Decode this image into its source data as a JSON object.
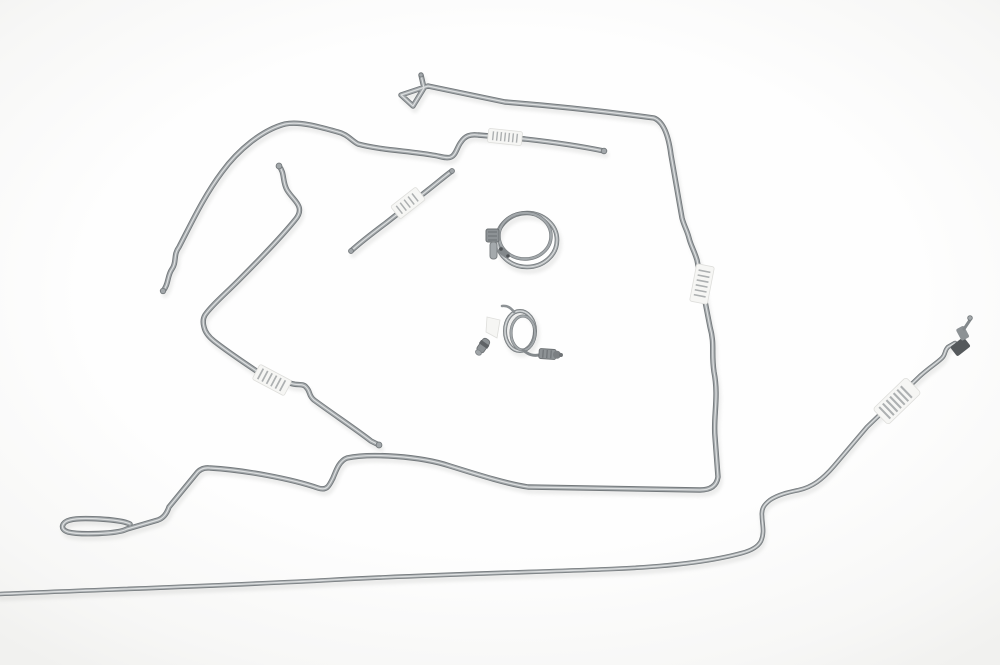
{
  "scene": {
    "type": "product-photograph",
    "subject": "Pre-bent steel automotive brake and fuel line kit with two coiled hoses, wrap labels and fittings, laid out on a white seamless background",
    "background": "#fcfcfc",
    "colors": {
      "tubeBody": "#a2a7aa",
      "tubeEdge": "#74797c",
      "tubeHighlight": "#e3e5e6",
      "labelFace": "#f6f6f4",
      "labelStripe": "#94989b",
      "fittingDark": "#55595c",
      "fittingMid": "#8d9295"
    }
  },
  "parts": [
    {
      "name": "main front-to-rear line",
      "features": "flattened loop end at lower left, long run across the middle, vertical right side with wrap label, triangular hook end at top"
    },
    {
      "name": "upper return line",
      "features": "sweeping arc down to open end at left, shallow run to open end at right, barcode wrap label near middle"
    },
    {
      "name": "left vapor line",
      "features": "flared open end, V-bend on left side, barcode wrap label, flared open end lower middle"
    },
    {
      "name": "short center jumper line",
      "features": "diagonal segment with barcode wrap label and open ends"
    },
    {
      "name": "rear long line",
      "features": "full-width gentle curve along bottom, S-riser on right, wrap label, tube nut and flare fitting at upper right end"
    },
    {
      "name": "large coiled hose",
      "features": "one-and-a-half turn coil with clamp and valve fitting at left"
    },
    {
      "name": "small coiled hose",
      "features": "tight coil with ridged end fitting at right, small angled fitting at left, white tag"
    }
  ],
  "labels": {
    "count": 5,
    "style": "white wrap-around labels with barcode-like stripes"
  }
}
